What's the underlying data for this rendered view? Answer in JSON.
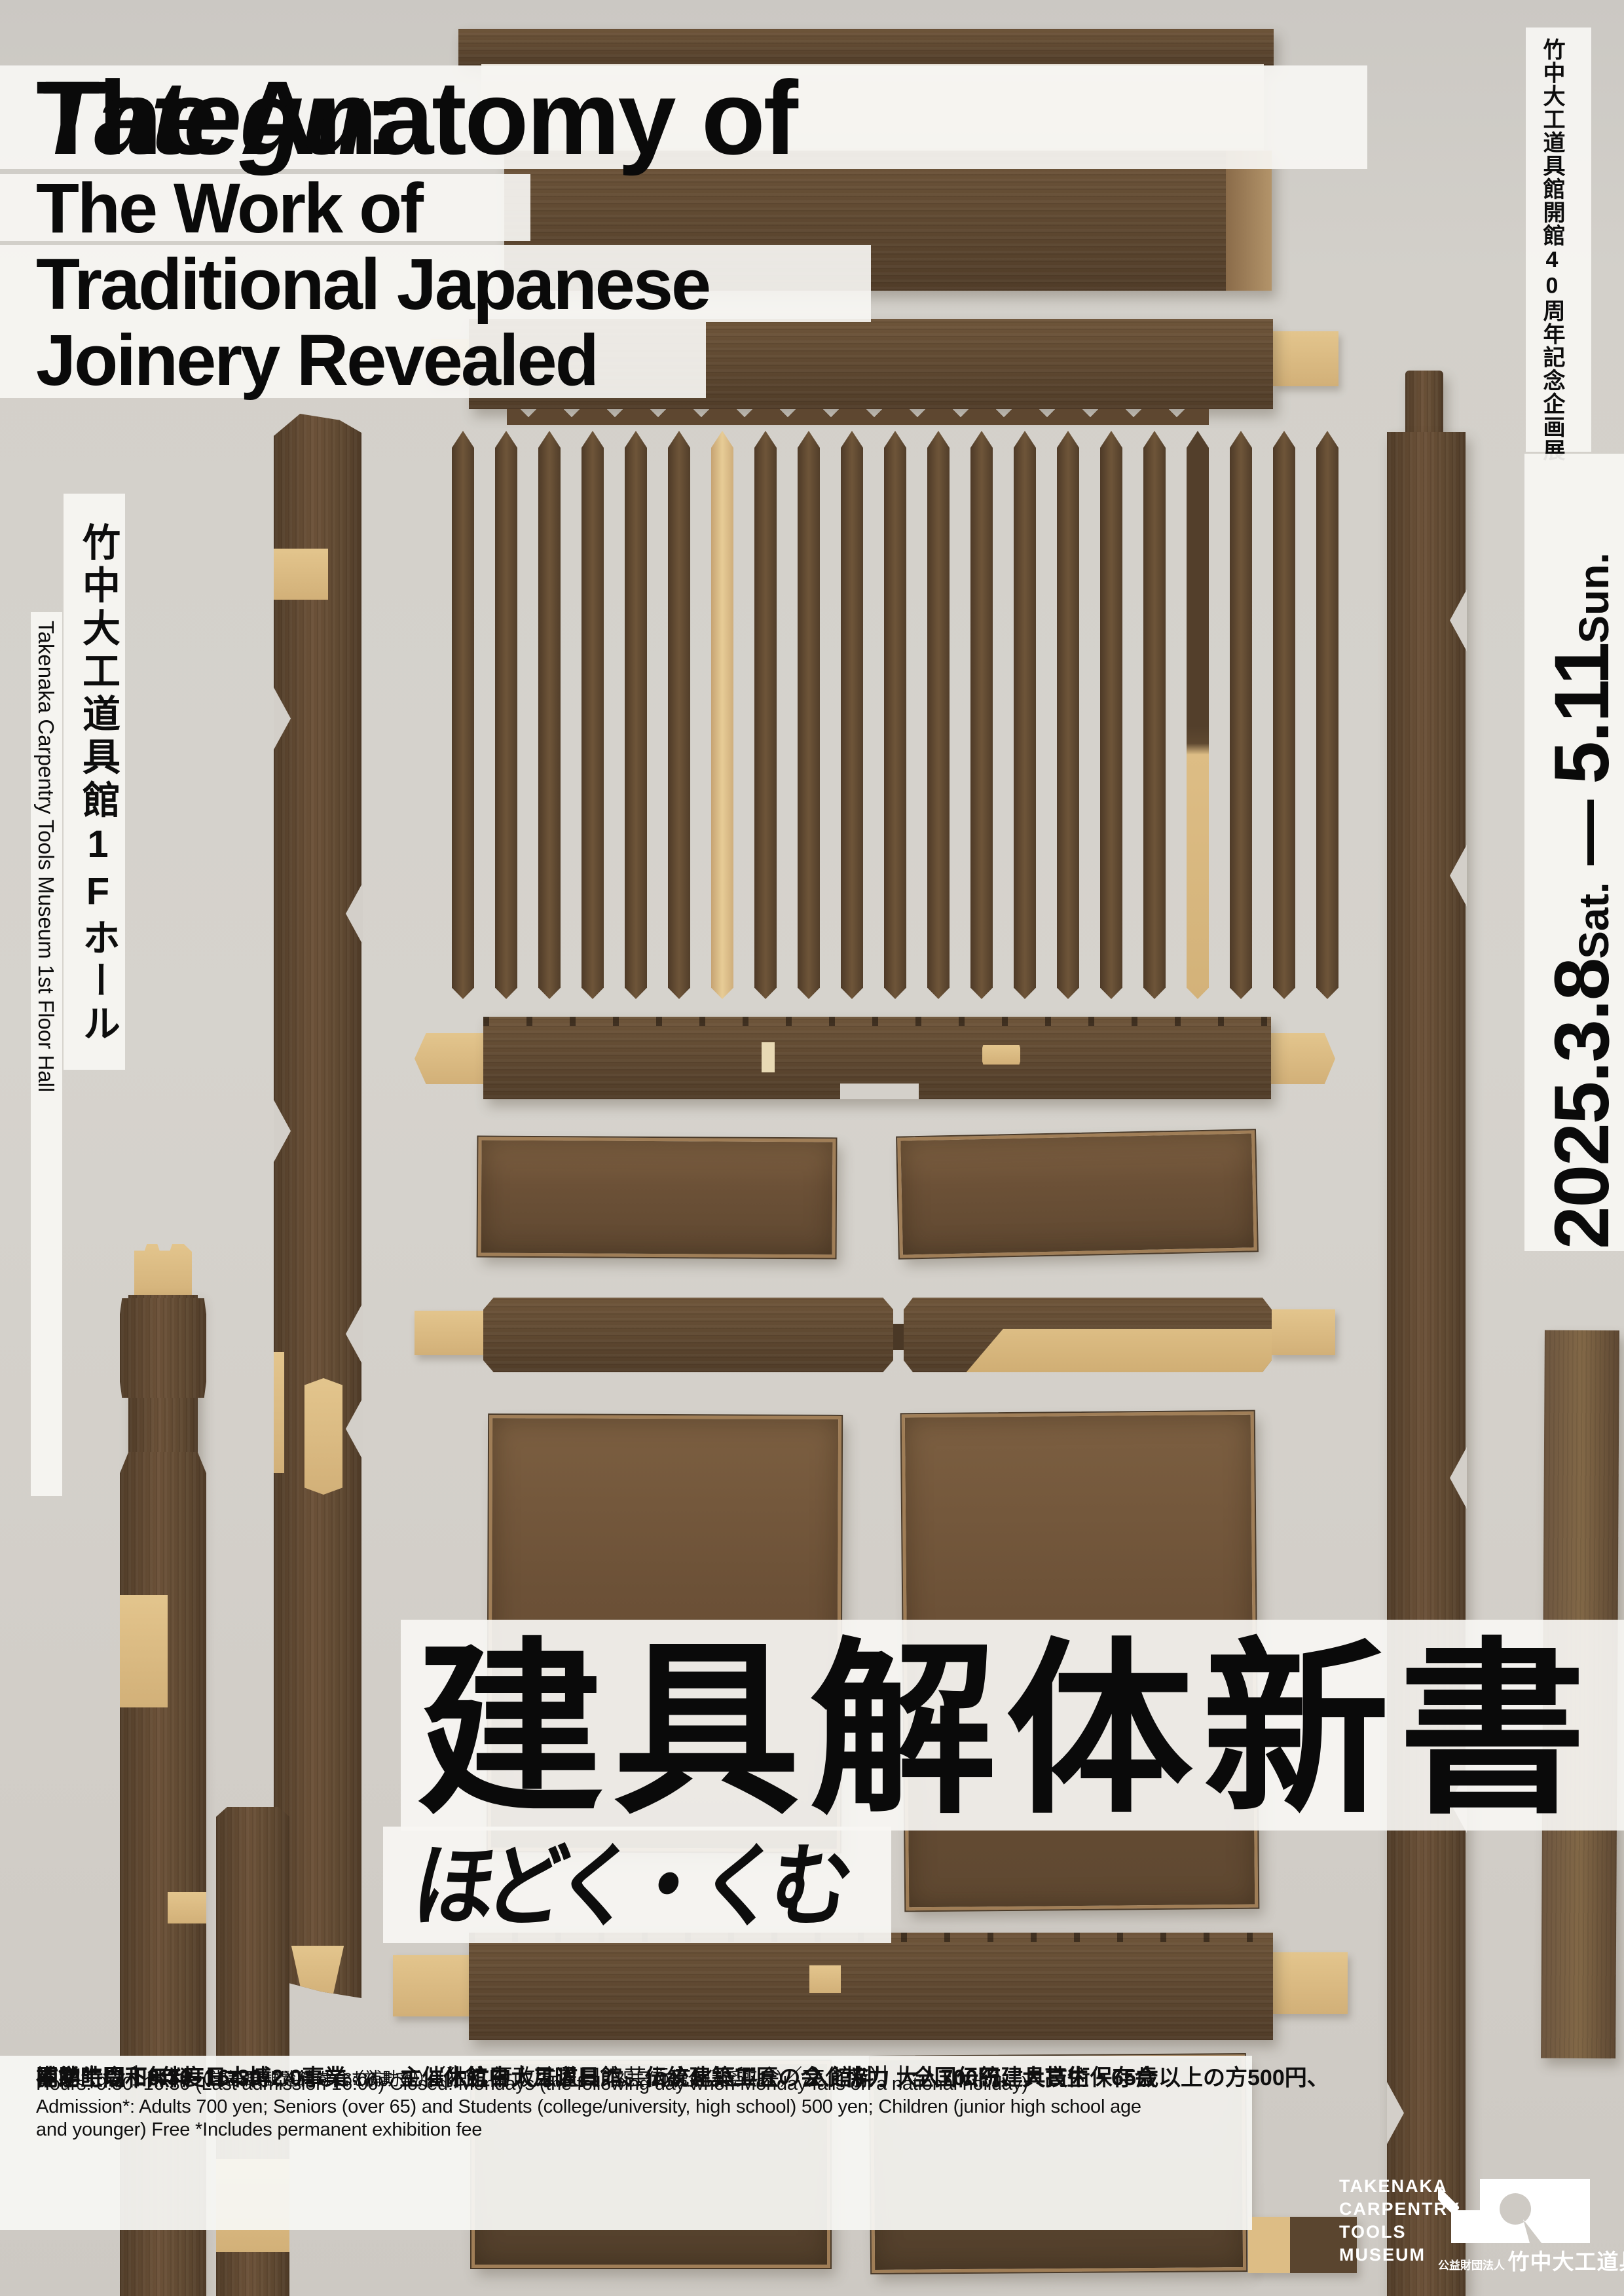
{
  "title": {
    "l1_pre": "The Anatomy of ",
    "l1_italic": "Tategu",
    "l1_post": ":",
    "l2": "The Work of",
    "l3": "Traditional Japanese",
    "l4": "Joinery Revealed"
  },
  "left_rail": {
    "jp": "竹中大工道具館1Fホール",
    "en": "Takenaka Carpentry Tools Museum 1st Floor Hall"
  },
  "right_rail": {
    "jp": "竹中大工道具館開館40周年記念企画展",
    "date_start": "2025.3.8",
    "date_start_day": "Sat.",
    "date_dash": " ― ",
    "date_end": "5.11",
    "date_end_day": "Sun."
  },
  "main_title": {
    "kanji": "建具解体新書",
    "kana": "ほどく・くむ"
  },
  "info": {
    "jp1": [
      {
        "t": "開館時間",
        "b": 1
      },
      {
        "t": "｜",
        "b": 1
      },
      {
        "t": "9:30−16:30",
        "b": 1
      },
      {
        "t": "（入館は16:00まで）",
        "s": 1
      },
      {
        "t": "　"
      },
      {
        "t": "休館日",
        "b": 1
      },
      {
        "t": "｜",
        "b": 1
      },
      {
        "t": "月曜日",
        "b": 1
      },
      {
        "t": "（祝日の場合は翌平日）",
        "s": 1
      },
      {
        "t": "　"
      },
      {
        "t": "入館料",
        "b": 1
      },
      {
        "t": "｜",
        "b": 1
      },
      {
        "t": "大人700円、大高生・65歳以上の方500円、",
        "b": 1
      }
    ],
    "jp2": [
      {
        "t": "中学生以下無料",
        "b": 1
      },
      {
        "t": "（常設展観覧料を含む）",
        "s": 1
      },
      {
        "t": "　"
      },
      {
        "t": "主催",
        "b": 1
      },
      {
        "t": "｜",
        "b": 1
      },
      {
        "t": "竹中大工道具館、伝統建築工匠の会",
        "b": 1
      },
      {
        "t": "　"
      },
      {
        "t": "協力",
        "b": 1
      },
      {
        "t": "｜",
        "b": 1
      },
      {
        "t": "全国伝統建具技術保存会",
        "b": 1
      }
    ],
    "jp3": [
      {
        "t": "補助",
        "b": 1
      },
      {
        "t": "｜",
        "b": 1
      },
      {
        "t": "令和6年度日本博2.0事業",
        "b": 1
      },
      {
        "t": "（補助型）",
        "s": 1
      },
      {
        "t": "（独立行政法人日本芸術文化振興会／文化庁）"
      }
    ],
    "en_lines": [
      "Hours: 9:30–16:30 (Last admission 16:00)  Closed: Mondays (the following day when Monday falls on a national holiday)",
      "Admission*: Adults 700 yen; Seniors (over 65) and Students (college/university, high school) 500 yen; Children (junior high school age",
      "and younger) Free *Includes permanent exhibition fee"
    ]
  },
  "logo": {
    "en_lines": [
      "TAKENAKA",
      "CARPENTRY",
      "TOOLS",
      "MUSEUM"
    ],
    "jp_small": "公益財団法人",
    "jp_large": "竹中大工道具館"
  },
  "colors": {
    "background_gray": "#d3d0ca",
    "strip_white": "#f7f6f3",
    "text_black": "#0a0a0a",
    "wood_brown": "#5d4730",
    "wood_tan": "#d9ba82",
    "logo_white": "#ffffff"
  }
}
